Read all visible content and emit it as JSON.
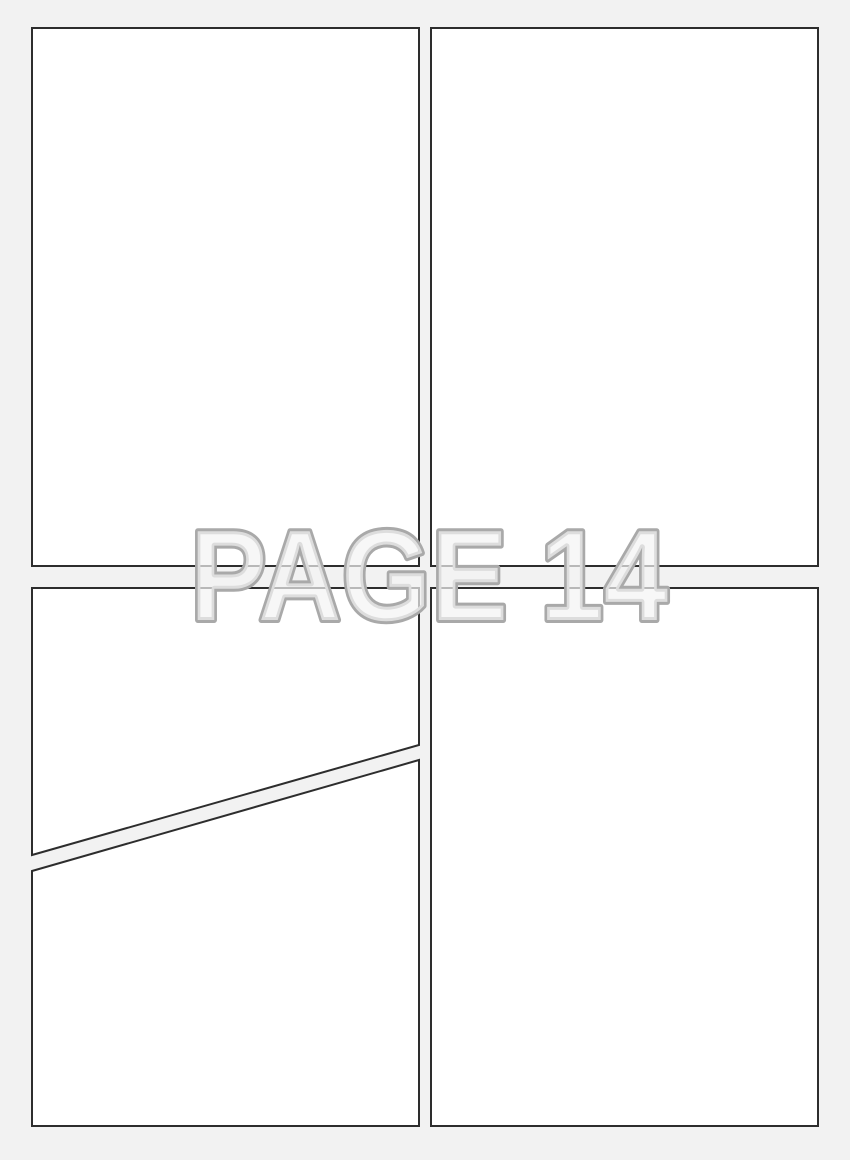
{
  "page": {
    "watermark_text": "PAGE 14",
    "colors": {
      "background": "#f2f2f2",
      "panel_fill": "#ffffff",
      "panel_border": "#2d2d2d",
      "watermark_stroke": "#a9a9a9",
      "watermark_fill": "rgba(244,244,244,0.7)"
    },
    "panels": [
      {
        "name": "panel-top-left",
        "shape": "rectangle"
      },
      {
        "name": "panel-top-right",
        "shape": "rectangle"
      },
      {
        "name": "panel-middle-left",
        "shape": "diagonal-trapezoid"
      },
      {
        "name": "panel-bottom-left",
        "shape": "diagonal-trapezoid"
      },
      {
        "name": "panel-bottom-right",
        "shape": "rectangle"
      }
    ]
  }
}
